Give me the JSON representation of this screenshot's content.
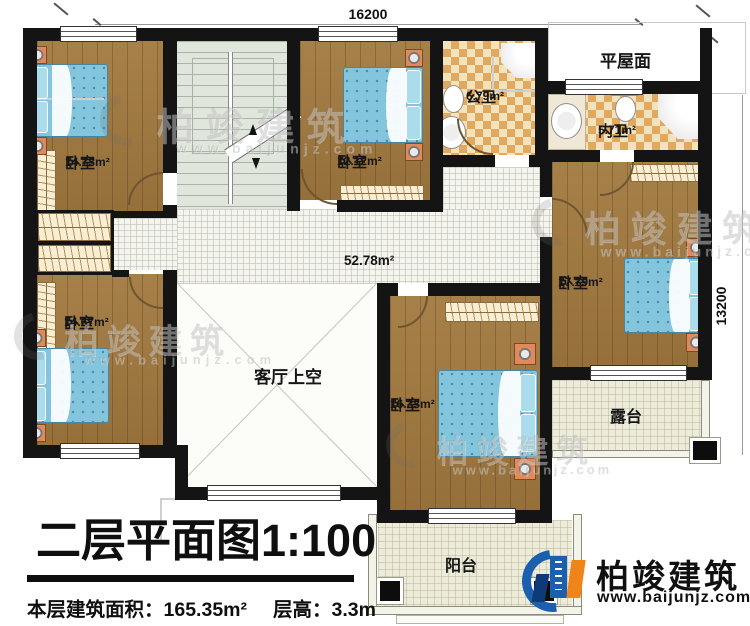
{
  "plan": {
    "title": "二层平面图",
    "scale": "1:100",
    "info": {
      "area_label": "本层建筑面积：",
      "area_value": "165.35m²",
      "height_label": "层高：",
      "height_value": "3.3m"
    },
    "dimensions": {
      "width": "16200",
      "depth": "13200"
    },
    "rooms": {
      "bedroom_tl": {
        "name": "卧室",
        "area": "14.73m²"
      },
      "bedroom_tm": {
        "name": "卧室",
        "area": "12.12m²"
      },
      "bedroom_bl": {
        "name": "卧室",
        "area": "14.67m²"
      },
      "bedroom_bc": {
        "name": "卧室",
        "area": "16.33m²"
      },
      "bedroom_r": {
        "name": "卧室",
        "area": "17.79m²"
      },
      "public_bath": {
        "name": "公卫",
        "area": "6.79m²"
      },
      "inner_bath": {
        "name": "内卫",
        "area": "5.71m²"
      },
      "flat_roof": {
        "name": "平屋面"
      },
      "void": {
        "name": "客厅上空"
      },
      "hall": {
        "area": "52.78m²"
      },
      "terrace": {
        "name": "露台"
      },
      "balcony": {
        "name": "阳台"
      }
    },
    "branding": {
      "company": "柏竣建筑",
      "website": "www.baijunjz.com"
    },
    "watermark": {
      "text": "柏竣建筑",
      "url": "www.baijunjz.com"
    }
  }
}
